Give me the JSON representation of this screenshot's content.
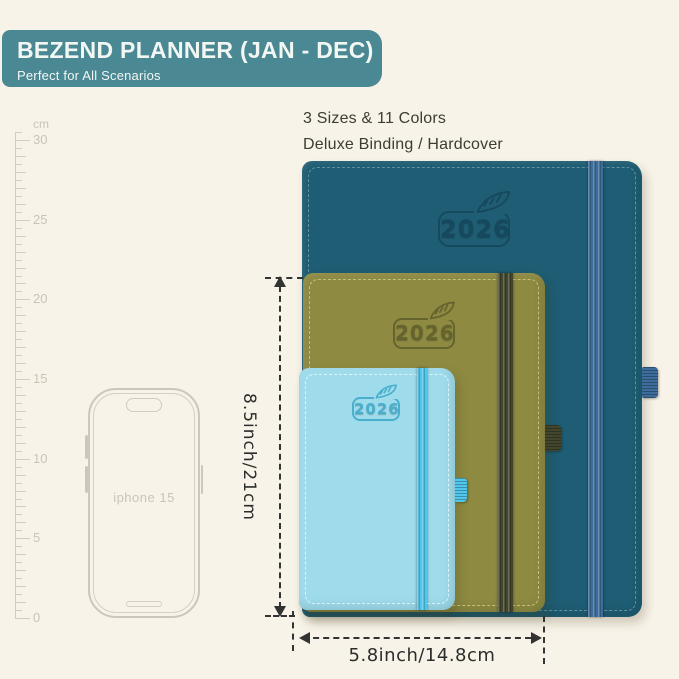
{
  "header": {
    "title": "BEZEND PLANNER (JAN - DEC)",
    "subtitle": "Perfect for All Scenarios"
  },
  "highlights": {
    "line1": "3 Sizes & 11 Colors",
    "line2": "Deluxe Binding / Hardcover"
  },
  "ruler": {
    "unit": "cm",
    "labels": [
      30,
      25,
      20,
      15,
      10,
      5,
      0
    ]
  },
  "phone": {
    "label": "iphone 15"
  },
  "notebooks": [
    {
      "id": "large-teal",
      "year": "2026"
    },
    {
      "id": "medium-olive",
      "year": "2026"
    },
    {
      "id": "small-lightblue",
      "year": "2026"
    }
  ],
  "dimensions": {
    "height": "8.5inch/21cm",
    "width": "5.8inch/14.8cm"
  },
  "colors": {
    "page-bg": "#f8f3e8",
    "banner-bg": "#4a8893",
    "banner-text": "#f2f7f4",
    "text-dark": "#3c3b35",
    "dim-line": "#333333",
    "ruler-gray": "#cfccc1",
    "ruler-text": "#c8c4b9",
    "phone-gray": "#cbc7bc",
    "nb1-cover": "#1e5d73",
    "nb1-band": "#3d6d9a",
    "nb1-logo": "#16495e",
    "nb1-stitch": "#6f9aa8",
    "nb2-cover": "#8e8a42",
    "nb2-band": "#41462c",
    "nb2-logo": "#66642e",
    "nb2-stitch": "#cdcb82",
    "nb3-cover": "#9edcec",
    "nb3-band": "#50c8ee",
    "nb3-logo": "#4aaecd",
    "nb3-stitch": "#e8f8fc"
  }
}
